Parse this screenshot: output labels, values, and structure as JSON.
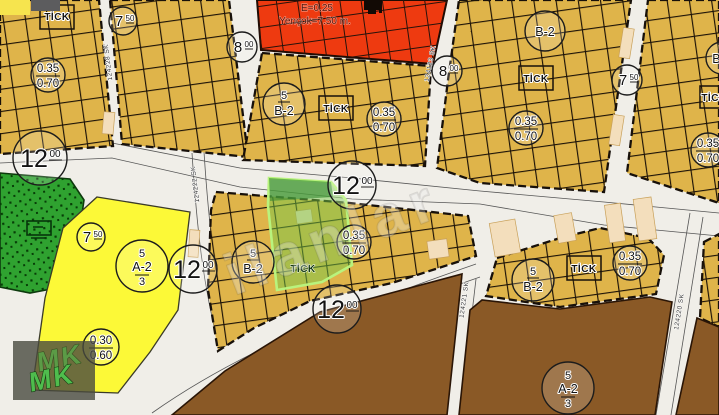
{
  "labels": {
    "tick": "TİCK",
    "zone_b2_plain": "B-2",
    "zone_b2_top": "5",
    "zone_b2_bottom": "B-2",
    "zone_a23_top": "5",
    "zone_a23_mid": "A-2",
    "zone_a23_bottom": "3",
    "ratio_35_top": "0.35",
    "ratio_35_bottom": "0.70",
    "ratio_30_top": "0.30",
    "ratio_30_bottom": "0.60",
    "w7_main": "7",
    "w7_sup": "50",
    "w8_main": "8",
    "w8_sup": "00",
    "w12_main": "12",
    "w12_sup": "00",
    "red_e": "E=0.25",
    "red_h": "Yençok=7.50 m."
  },
  "roads": {
    "r124228": "124228 SK",
    "r124123": "124123 SK",
    "r124222": "124222 SK",
    "r124221": "124221 SK",
    "r124220": "124220 SK"
  },
  "watermark": {
    "text": "ilanlar",
    "logo": "MK"
  },
  "icons": [
    "mosque-icon",
    "park-structure-icon"
  ],
  "colors": {
    "mustard_zone": "#dfb44a",
    "red_zone": "#ee3a10",
    "park_green": "#2fa230",
    "yellow_zone": "#fcf937",
    "brown_zone": "#8a5926",
    "road": "#f0eee8",
    "building_footprint": "#f3debc",
    "subject_highlight": "#7cc74a",
    "logo_green": "#4ec24e"
  }
}
